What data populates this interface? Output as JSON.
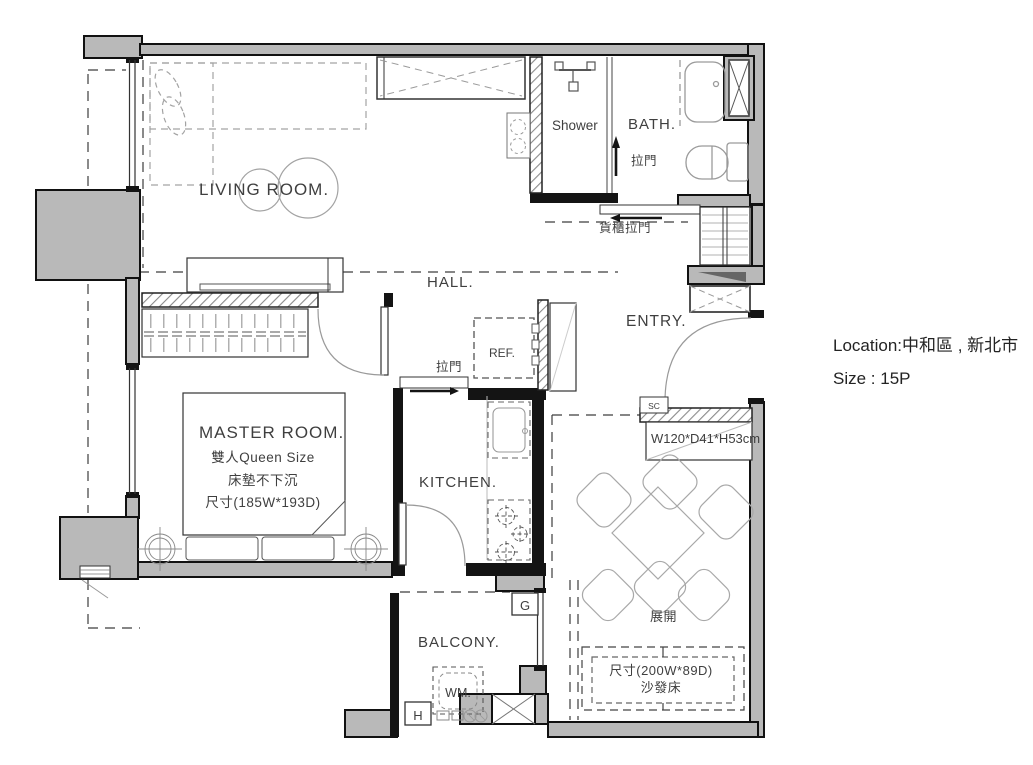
{
  "page": {
    "background": "#ffffff"
  },
  "plan": {
    "rooms": {
      "living": "LIVING ROOM.",
      "shower": "Shower",
      "bath": "BATH.",
      "hall": "HALL.",
      "entry": "ENTRY.",
      "master": "MASTER ROOM.",
      "kitchen": "KITCHEN.",
      "balcony": "BALCONY."
    },
    "master_notes": {
      "line1": "雙人Queen Size",
      "line2": "床墊不下沉",
      "line3": "尺寸(185W*193D)"
    },
    "doors": {
      "bath_sliding": "拉門",
      "storage_sliding": "貨櫃拉門",
      "kitchen_sliding": "拉門"
    },
    "fixtures": {
      "fridge": "REF.",
      "washing_machine": "WM.",
      "shoe_cabinet_tag": "SC"
    },
    "cabinet_dim": "W120*D41*H53cm",
    "sofa_area": {
      "unfold": "展開",
      "dim": "尺寸(200W*89D)",
      "type": "沙發床"
    },
    "markers": {
      "g": "G",
      "h": "H"
    }
  },
  "info": {
    "location": "Location:中和區 , 新北市",
    "size": "Size : 15P"
  },
  "colors": {
    "wall_fill": "#b9b9b9",
    "wall_stroke": "#111111",
    "hatch_line": "#8a8a8a",
    "furniture_line": "#9a9a9a",
    "dash_line": "#3d3d3d",
    "label_text": "#3f3f3f"
  }
}
